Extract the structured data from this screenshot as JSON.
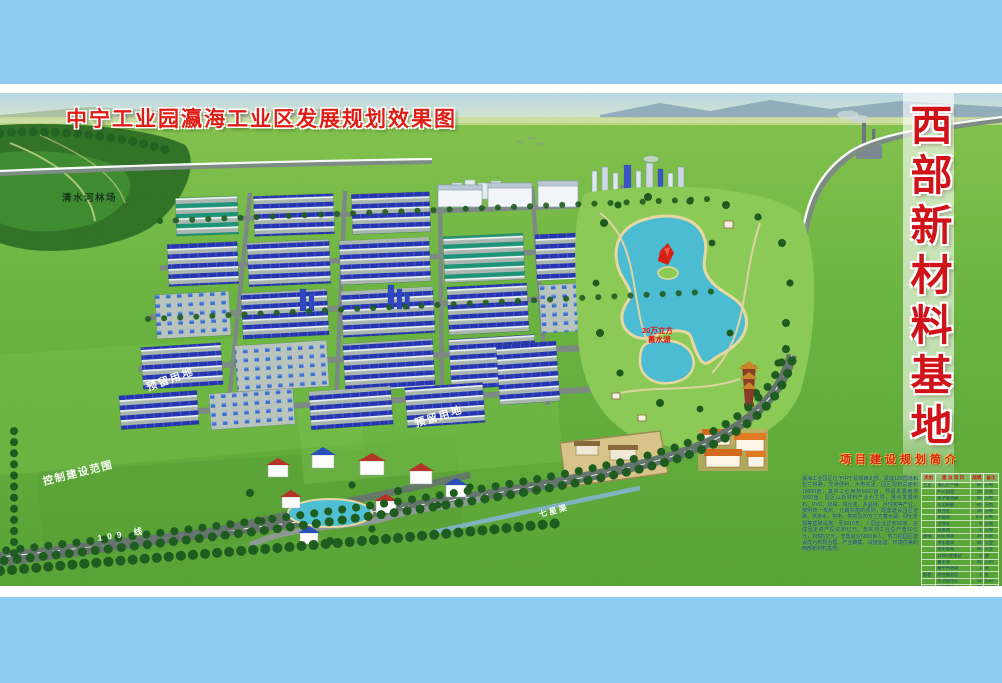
{
  "page": {
    "title": "中宁工业园瀛海工业区发展规划效果图",
    "banner_vertical": "西部新材料基地",
    "colors": {
      "band_blue": "#8ecdf1",
      "title_red": "#e01d15",
      "banner_red": "#d01318",
      "field_green": "#62ae3c",
      "lake_cyan": "#4cbcd2",
      "roof_blue": "#2636b0"
    }
  },
  "map_labels": {
    "forest": "清水河林场",
    "reserved_land_1": "预留用地",
    "reserved_land_2": "预留用地",
    "construction_scope": "控制建设范围",
    "road_109_bottom": "109  线",
    "road_109_right": "109 线",
    "canal": "七星渠",
    "lake_line1": "20万立方",
    "lake_line2": "蓄水湖"
  },
  "info_panel": {
    "title": "项目建设规划简介",
    "paragraph": "瀛海工业园区位于中宁县城西北部，紧临109国道和包兰铁路，交通便利，水电充足。园区规划总面积10000亩，其中工业用地6000亩，预留发展用地3000亩。园区以新材料产业为主导，重点发展电石、PVC、烧碱、铁合金、多晶硅、活性炭等产业，按照统一规划、分期实施的原则，配套建设园区道路、供排水、供电、供热及20万立方蓄水湖、绿化景观等基础设施。至2010年，入园企业达到30家，完成固定资产投资30亿元，年实现工业总产值50亿元，利税6亿元，安置就业6000余人，努力把园区建设成为布局合理、产业聚集、设施完善、环境优美的西部新材料基地。",
    "table": {
      "headers": [
        "类别",
        "建 设 项 目",
        "规模",
        "备注"
      ],
      "rows": [
        [
          "工业",
          "电石生产线",
          "30",
          "万吨"
        ],
        [
          "",
          "PVC树脂",
          "25",
          "万吨"
        ],
        [
          "",
          "离子膜烧碱",
          "20",
          "万吨"
        ],
        [
          "",
          "水泥粉磨",
          "60",
          "万吨"
        ],
        [
          "",
          "铁合金",
          "10",
          "万吨"
        ],
        [
          "",
          "多晶硅",
          "0.3",
          "万吨"
        ],
        [
          "",
          "活性炭",
          "5",
          "万吨"
        ],
        [
          "",
          "双氰胺",
          "2",
          "万吨"
        ],
        [
          "基础",
          "园区道路",
          "28",
          "公里"
        ],
        [
          "",
          "供水管网",
          "35",
          "公里"
        ],
        [
          "",
          "排水管网",
          "30",
          "公里"
        ],
        [
          "",
          "110kV变电站",
          "2",
          "座"
        ],
        [
          "",
          "蓄水湖",
          "20",
          "万m³"
        ],
        [
          "",
          "集中供热站",
          "1",
          "处"
        ],
        [
          "配套",
          "综合服务区",
          "1",
          "处"
        ],
        [
          "",
          "生活居住区",
          "12",
          "万㎡"
        ],
        [
          "",
          "绿化景观",
          "60",
          "万㎡"
        ],
        [
          "",
          "防护林带",
          "15",
          "公里"
        ],
        [
          "",
          "污水处理厂",
          "1",
          "座"
        ]
      ]
    }
  }
}
